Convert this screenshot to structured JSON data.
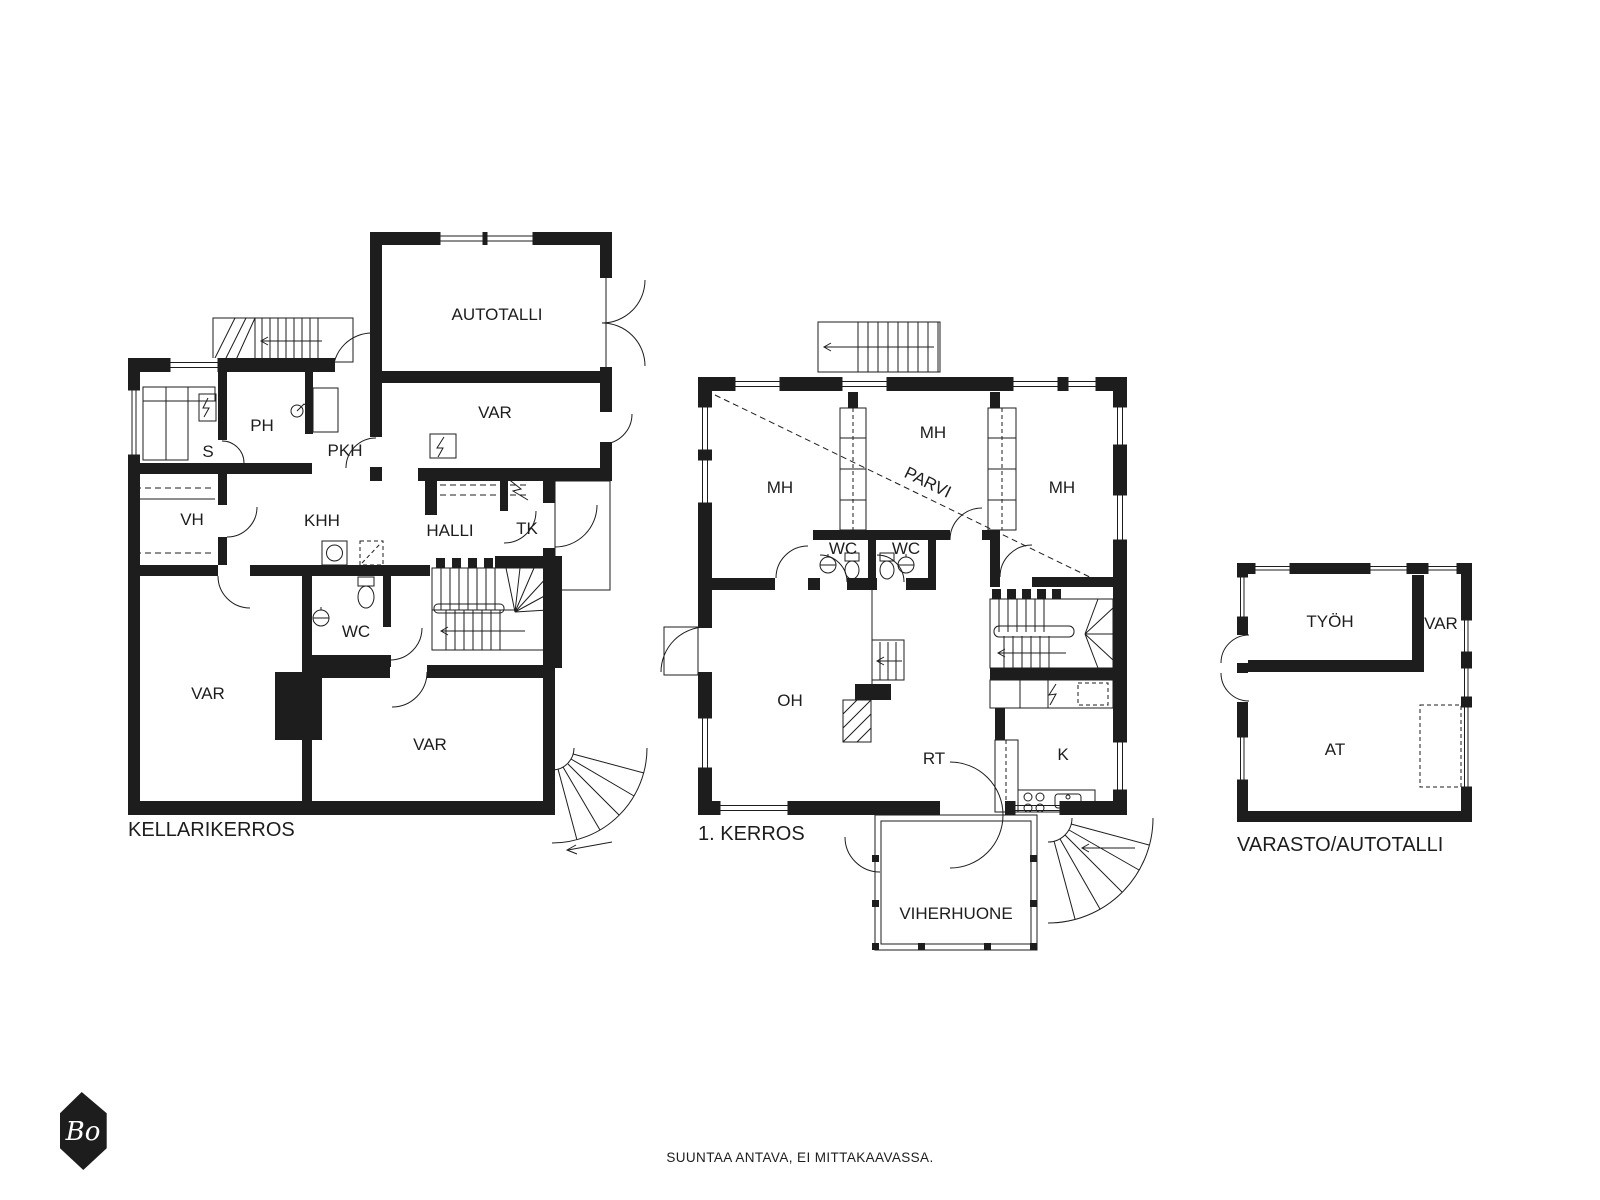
{
  "colors": {
    "ink": "#1d1d1d",
    "background": "#ffffff"
  },
  "plans": {
    "basement": {
      "title": "KELLARIKERROS",
      "rooms": [
        "AUTOTALLI",
        "VAR",
        "PH",
        "S",
        "PKH",
        "VH",
        "KHH",
        "HALLI",
        "TK",
        "WC",
        "VAR",
        "VAR"
      ]
    },
    "first_floor": {
      "title": "1. KERROS",
      "rooms": [
        "MH",
        "MH",
        "MH",
        "PARVI",
        "WC",
        "WC",
        "OH",
        "RT",
        "K",
        "VIHERHUONE"
      ]
    },
    "outbuilding": {
      "title": "VARASTO/AUTOTALLI",
      "rooms": [
        "TYÖH",
        "VAR",
        "AT"
      ]
    }
  },
  "footer": {
    "note": "SUUNTAA ANTAVA, EI MITTAKAAVASSA."
  },
  "logo": {
    "text": "Bo"
  }
}
